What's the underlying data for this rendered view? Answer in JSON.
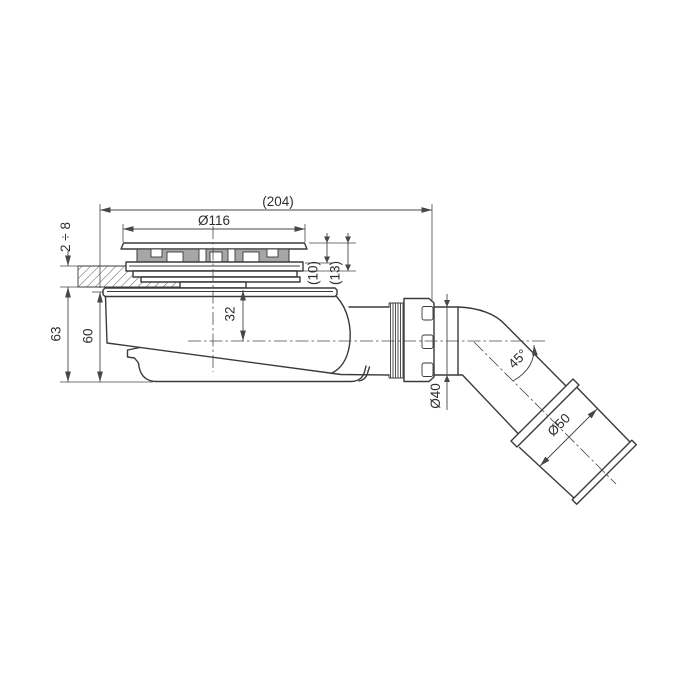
{
  "drawing": {
    "title": "shower-trap-technical-drawing",
    "colors": {
      "background": "#ffffff",
      "outline": "#3a3a3a",
      "dimension": "#474747",
      "grate_fill": "#a6a6a6"
    },
    "labels": {
      "overall_width": "(204)",
      "grate_diameter": "Ø116",
      "cover_height_10": "(10)",
      "cover_height_13": "(13)",
      "tray_thickness": "2 ÷ 8",
      "total_depth": "63",
      "body_depth": "60",
      "axis_depth": "32",
      "outlet_diameter": "Ø40",
      "elbow_angle": "45°",
      "socket_diameter": "Ø50"
    }
  }
}
